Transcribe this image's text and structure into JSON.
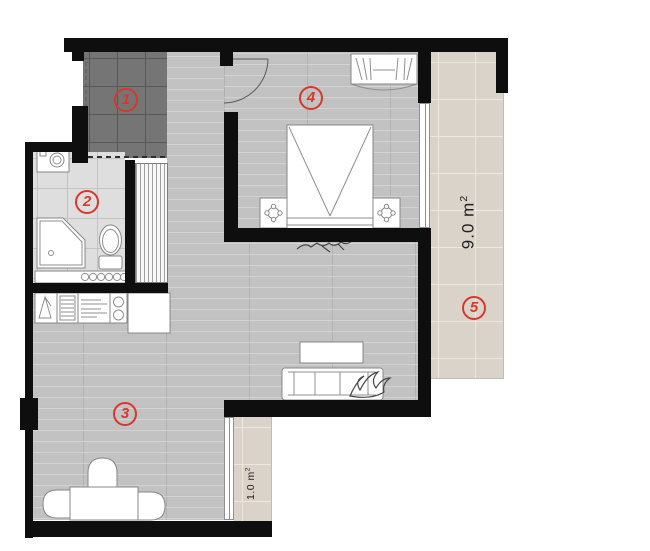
{
  "theme": {
    "wall_color": "#0e0e0e",
    "label_color": "#d8372b",
    "area_text_color": "#1f1f1f"
  },
  "rooms": [
    {
      "label": "1"
    },
    {
      "label": "2"
    },
    {
      "label": "3"
    },
    {
      "label": "4"
    },
    {
      "label": "5"
    }
  ],
  "areas": [
    {
      "value": "9.0 m",
      "sup": "2"
    },
    {
      "value": "1.0 m",
      "sup": "2"
    }
  ]
}
